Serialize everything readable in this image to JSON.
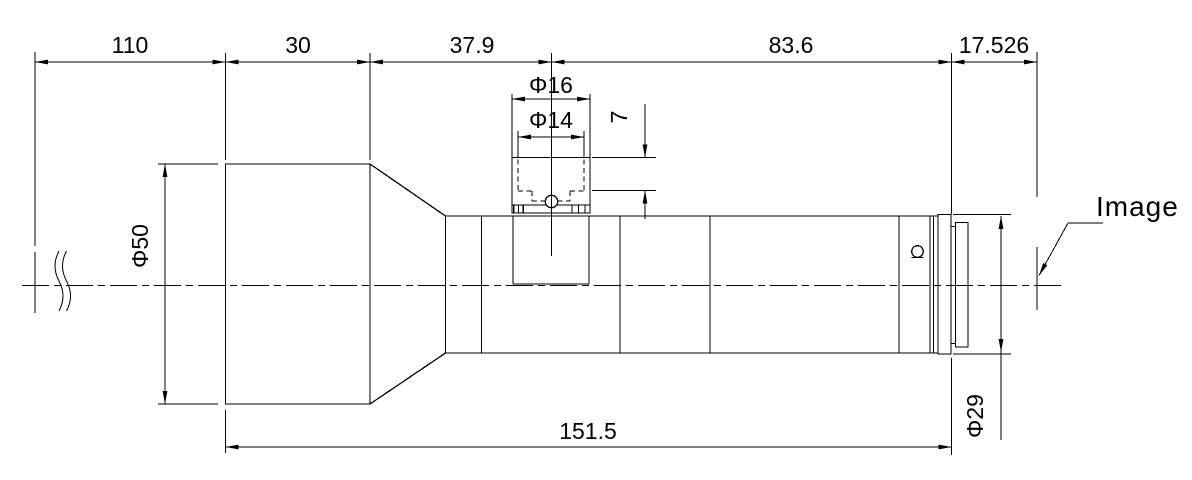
{
  "labels": {
    "dim_110": "110",
    "dim_30": "30",
    "dim_37_9": "37.9",
    "dim_83_6": "83.6",
    "dim_17_526": "17.526",
    "dim_151_5": "151.5",
    "dia_front": "Φ50",
    "dia_port_outer": "Φ16",
    "dia_port_inner": "Φ14",
    "dim_port_depth": "7",
    "dia_rear": "Φ29",
    "image_plane_label": "Image"
  },
  "dimensions_mm": {
    "object_to_front_face": 110,
    "front_barrel_length": 30,
    "front_face_to_port_center": 37.9,
    "port_center_to_flange": 83.6,
    "flange_to_image": 17.526,
    "housing_length": 151.5,
    "front_diameter": 50,
    "port_outer_diameter": 16,
    "port_inner_diameter": 14,
    "port_step_depth": 7,
    "rear_flange_diameter": 29
  },
  "colors": {
    "line": "#000000",
    "background": "#ffffff"
  }
}
